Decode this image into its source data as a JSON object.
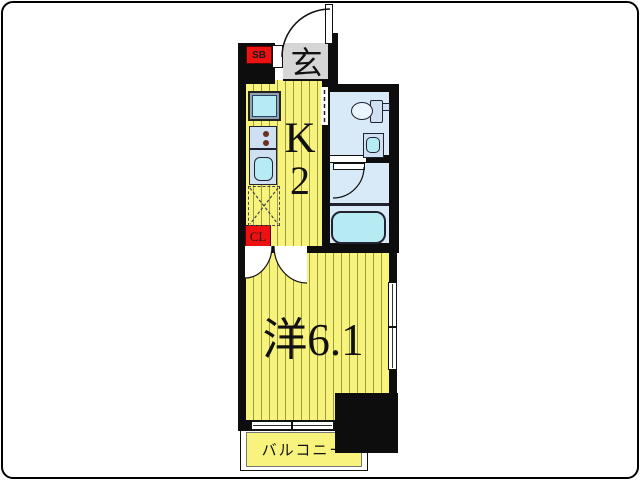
{
  "floorplan": {
    "type": "japanese-apartment-floor-plan",
    "labels": {
      "shoe_box": "SB",
      "entrance": "玄",
      "kitchen_letter": "K",
      "kitchen_size": "2",
      "main_room": "洋6.1",
      "closet": "CL",
      "balcony": "バルコニー"
    },
    "fixtures": [
      "washing-machine-space",
      "gas-stove",
      "kitchen-sink",
      "refrigerator-space",
      "toilet",
      "wash-basin",
      "bathtub"
    ],
    "colors": {
      "wall": "#0d0d0d",
      "floor_yellow": "#f8f37d",
      "floor_stripe": "#9c9c42",
      "entrance_gray": "#d6d6d6",
      "wet_floor": "#d8eaf8",
      "fixture_cyan": "#b6ebf3",
      "fixture_blue": "#cfe0f3",
      "accent_red": "#ee1111"
    }
  }
}
